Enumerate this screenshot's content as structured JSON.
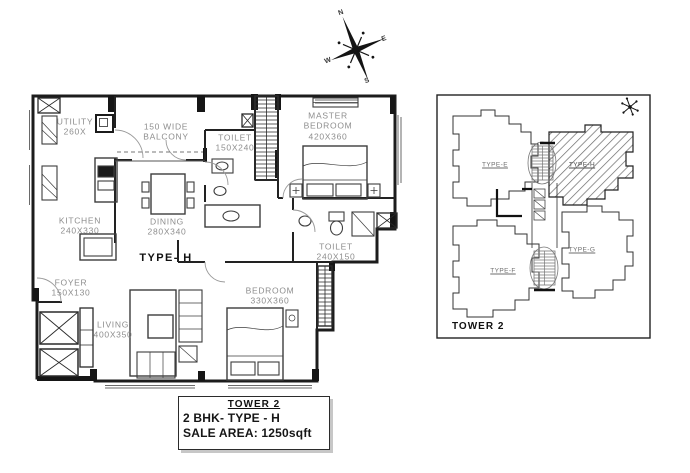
{
  "compass": {
    "n": "N",
    "e": "E",
    "w": "W",
    "s": "S"
  },
  "main_plan": {
    "type_label": "TYPE- H",
    "rooms": {
      "utility": {
        "name": "UTILITY",
        "dim": "260X"
      },
      "balcony": {
        "l1": "150 WIDE",
        "l2": "BALCONY"
      },
      "toilet_top": {
        "name": "TOILET",
        "dim": "150X240"
      },
      "master": {
        "l1": "MASTER",
        "l2": "BEDROOM",
        "dim": "420X360"
      },
      "kitchen": {
        "name": "KITCHEN",
        "dim": "240X330"
      },
      "dining": {
        "name": "DINING",
        "dim": "280X340"
      },
      "toilet_bottom": {
        "name": "TOILET",
        "dim": "240X150"
      },
      "foyer": {
        "name": "FOYER",
        "dim": "150X130"
      },
      "living": {
        "name": "LIVING",
        "dim": "400X350"
      },
      "bedroom": {
        "name": "BEDROOM",
        "dim": "330X360"
      }
    }
  },
  "info_box": {
    "tower": "TOWER 2",
    "bhk": "2 BHK-  TYPE - H",
    "area": "SALE AREA: 1250sqft"
  },
  "key_plan": {
    "tower": "TOWER 2",
    "unit_e": "TYPE-E",
    "unit_h": "TYPE-H",
    "unit_f": "TYPE-F",
    "unit_g": "TYPE-G"
  },
  "colors": {
    "wall": "#1c1c1c",
    "room_label": "#8e8e8e",
    "dark_text": "#111111"
  }
}
